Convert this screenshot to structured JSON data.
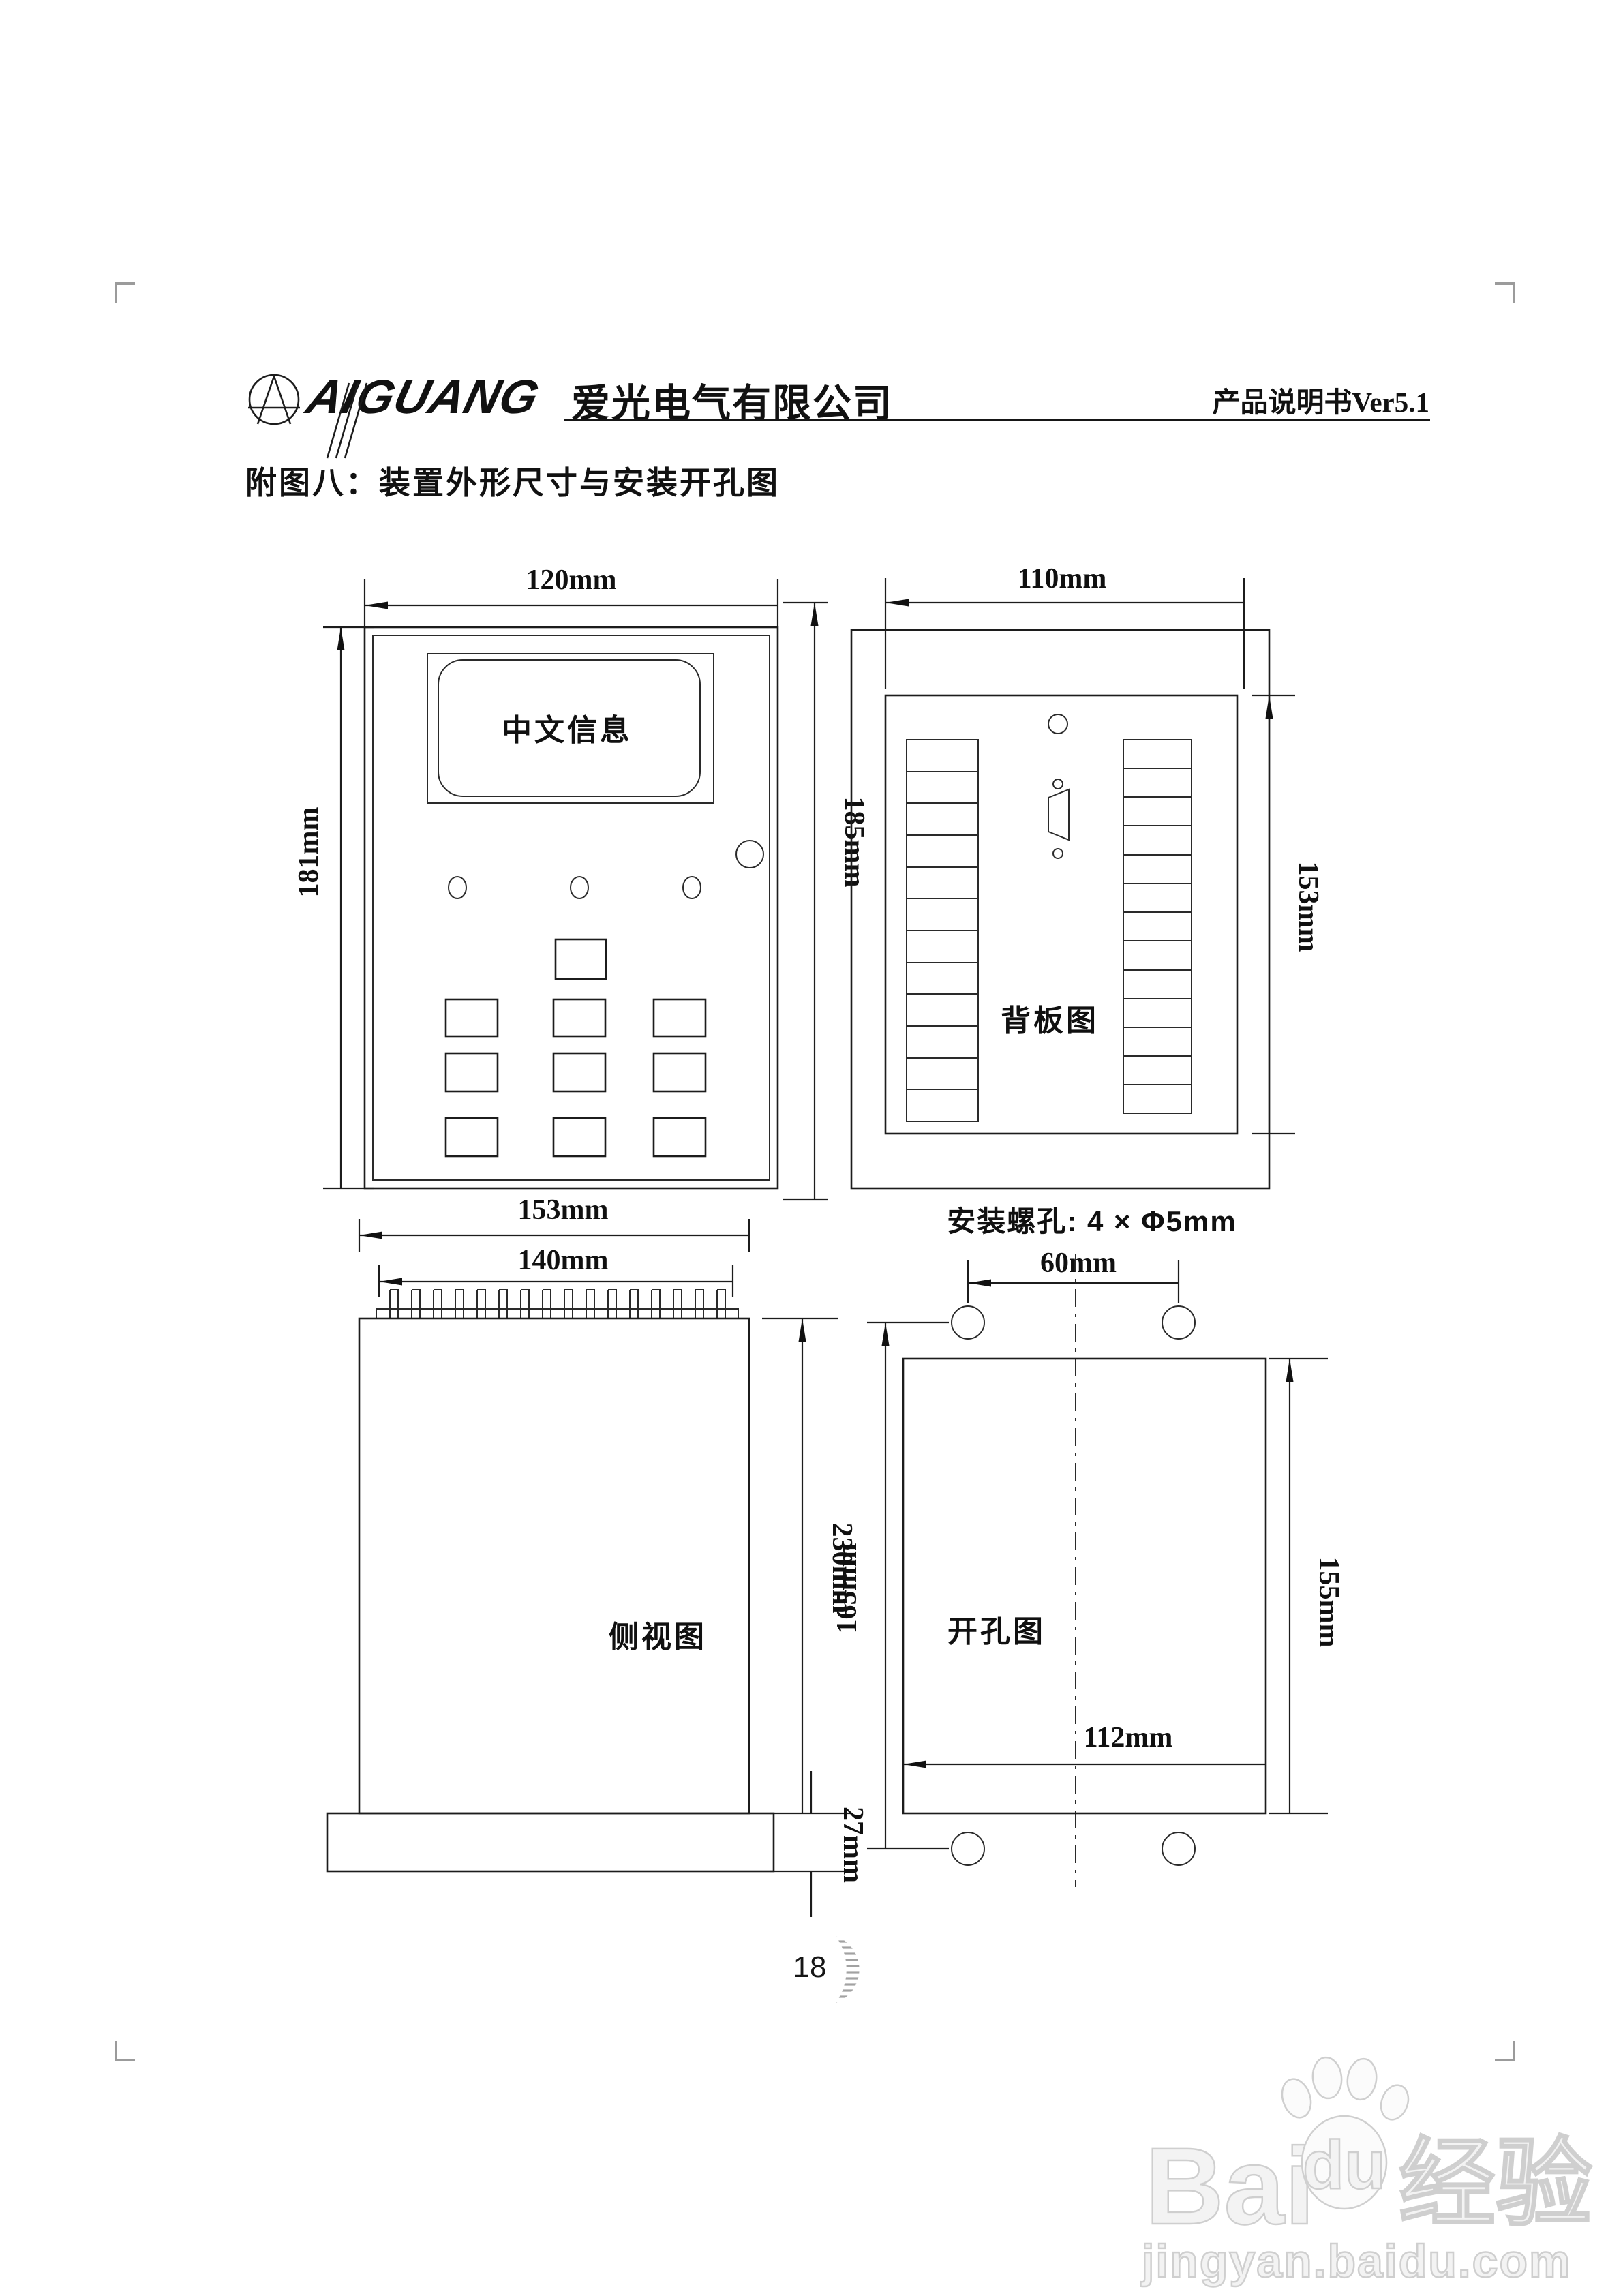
{
  "header": {
    "logo_text": "AIGUANG",
    "company": "爱光电气有限公司",
    "doc_ref": "产品说明书Ver5.1"
  },
  "title": "附图八：装置外形尺寸与安装开孔图",
  "front_view": {
    "screen_text": "中文信息",
    "dim_width": "120mm",
    "dim_height_left": "181mm",
    "dim_height_right": "185mm"
  },
  "back_view": {
    "label": "背板图",
    "dim_width": "110mm",
    "dim_height": "153mm"
  },
  "side_view": {
    "label": "侧视图",
    "dim_width_outer": "153mm",
    "dim_width_inner": "140mm",
    "dim_height": "230mm",
    "dim_flange_height": "27mm"
  },
  "cutout_view": {
    "label": "开孔图",
    "mount_note": "安装螺孔: 4 × Φ5mm",
    "dim_hole_spacing": "60mm",
    "dim_height_left": "165mm",
    "dim_height_right": "155mm",
    "dim_width": "112mm"
  },
  "footer": {
    "page_number": "18"
  },
  "watermark": {
    "brand": "Bai",
    "brand2": "du",
    "brand_suffix": "经验",
    "url": "jingyan.baidu.com"
  }
}
